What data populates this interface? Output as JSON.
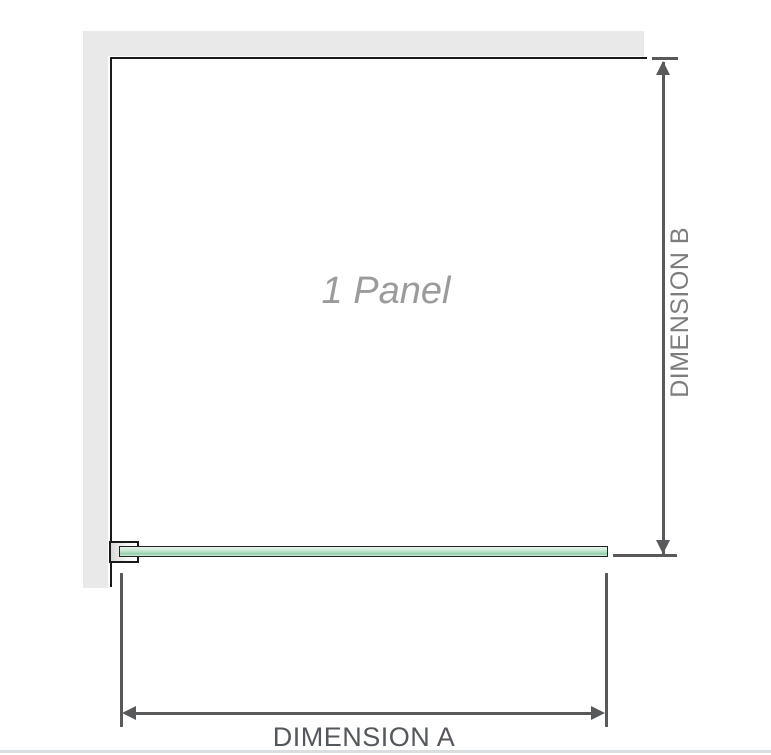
{
  "diagram": {
    "panel_label": "1 Panel",
    "dimension_a_label": "DIMENSION A",
    "dimension_b_label": "DIMENSION B"
  },
  "colors": {
    "wall": "#e9e9e9",
    "frame_line": "#1a1a1a",
    "dimension_line": "#58595b",
    "dimension_a_text": "#54575b",
    "dimension_b_text": "#7d7d7d",
    "panel_text": "#9b9b9b",
    "glass_green": "#8fcfa8",
    "glass_light": "#e7f4eb",
    "baseline_rule": "#dbdee1"
  }
}
